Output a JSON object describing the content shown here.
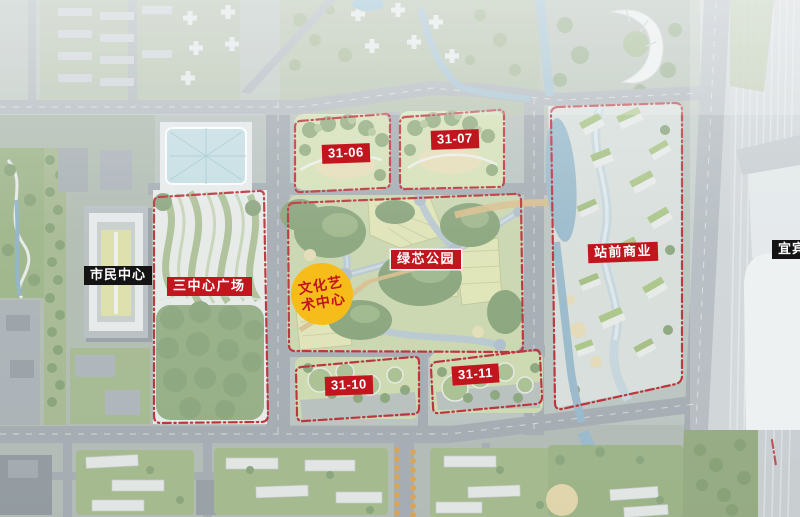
{
  "labels": {
    "citizens_center": "市民中心",
    "three_center_plaza": "三中心广场",
    "culture_art_center_line1": "文化艺",
    "culture_art_center_line2": "术中心",
    "green_core_park": "绿芯公园",
    "station_front_commerce": "站前商业",
    "block_31_06": "31-06",
    "block_31_07": "31-07",
    "block_31_10": "31-10",
    "block_31_11": "31-11",
    "station_name_partial": "宜宾"
  },
  "colors": {
    "label_red_bg": "#c2161f",
    "label_black_bg": "#141414",
    "label_text": "#ffffff",
    "culture_badge_bg": "#f6bc1a",
    "culture_badge_text": "#c3141c",
    "boundary_red": "#b5121a",
    "water_blue": "#8fb3c6",
    "park_green": "#9db481",
    "road_gray": "#9ca3a9",
    "base_tone": "#b6bfba"
  }
}
